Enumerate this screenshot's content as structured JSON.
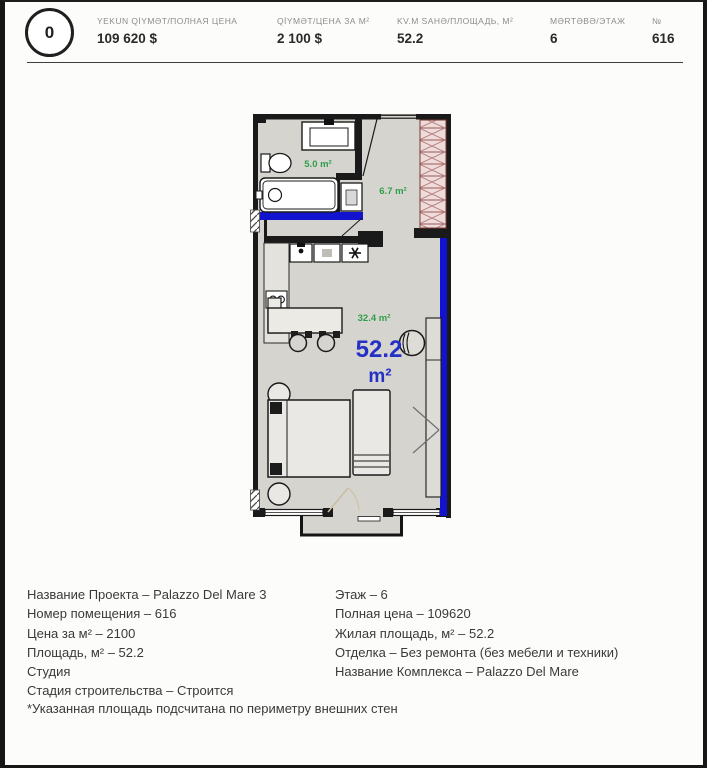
{
  "header": {
    "badge": "0",
    "columns": [
      {
        "label": "YEKUN QİYMƏT/ПОЛНАЯ ЦЕНА",
        "value": "109 620 $"
      },
      {
        "label": "QİYMƏT/ЦЕНА ЗА М²",
        "value": "2 100 $"
      },
      {
        "label": "KV.M SAHƏ/ПЛОЩАДЬ, М²",
        "value": "52.2"
      },
      {
        "label": "MƏRTƏBƏ/ЭТАЖ",
        "value": "6"
      },
      {
        "label": "№",
        "value": "616"
      }
    ]
  },
  "floorplan": {
    "labels": {
      "bathroom": "5.0 m²",
      "hallway": "6.7 m²",
      "living": "32.4 m²",
      "total_value": "52.2",
      "total_unit": "m²"
    },
    "colors": {
      "wall": "#1a1a1a",
      "floor": "#d6d4cf",
      "accent_blue": "#1213cf",
      "total_text_blue": "#2531c4",
      "area_green": "#2f9e4a",
      "wardrobe_hatch": "#a05e5c"
    }
  },
  "details": {
    "left": [
      "Название Проекта – Palazzo Del Mare 3",
      "Номер помещения – 616",
      "Цена за м² – 2100",
      "Площадь, м² – 52.2",
      "Студия",
      "Стадия строительства – Строится"
    ],
    "right": [
      "Этаж – 6",
      "Полная цена – 109620",
      "Жилая площадь, м² – 52.2",
      "Отделка – Без ремонта (без мебели и техники)",
      "Название Комплекса – Palazzo Del Mare"
    ],
    "footnote": "*Указанная площадь подсчитана по периметру внешних стен"
  }
}
